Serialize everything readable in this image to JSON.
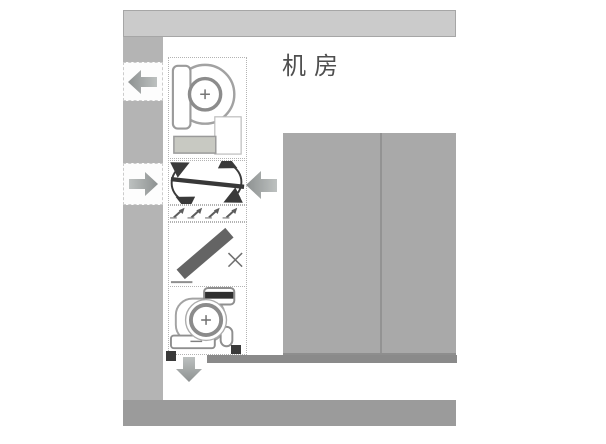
{
  "diagram": {
    "room_label": "机房",
    "components": [
      {
        "name": "supply-fan-icon",
        "type": "centrifugal-fan"
      },
      {
        "name": "filter-section",
        "type": "filter-with-casing"
      },
      {
        "name": "modulating-damper-icon",
        "type": "damper-blade-with-rotation-arrows"
      },
      {
        "name": "grille-icon",
        "type": "louver-grille"
      },
      {
        "name": "closed-damper-icon",
        "type": "diagonal-damper-with-x"
      },
      {
        "name": "return-fan-icon",
        "type": "centrifugal-fan"
      }
    ],
    "airflow": [
      {
        "name": "shaft-arrow-out",
        "direction": "left"
      },
      {
        "name": "shaft-arrow-in",
        "direction": "right"
      },
      {
        "name": "room-arrow-in",
        "direction": "left"
      },
      {
        "name": "exhaust-arrow-down",
        "direction": "down"
      }
    ],
    "colors": {
      "top_duct": "#cbcbcb",
      "shaft": "#b4b4b4",
      "equipment_block": "#a9a9a9",
      "block_shadow": "#8a8a8a",
      "bottom_duct": "#9b9b9b",
      "arrow_light": "#bdc1c0",
      "arrow_dark": "#8d9191",
      "damper_blade": "#383838",
      "filter_bar": "#646464",
      "outline": "#9a9a9a",
      "label_text": "#4f4f4f"
    }
  }
}
